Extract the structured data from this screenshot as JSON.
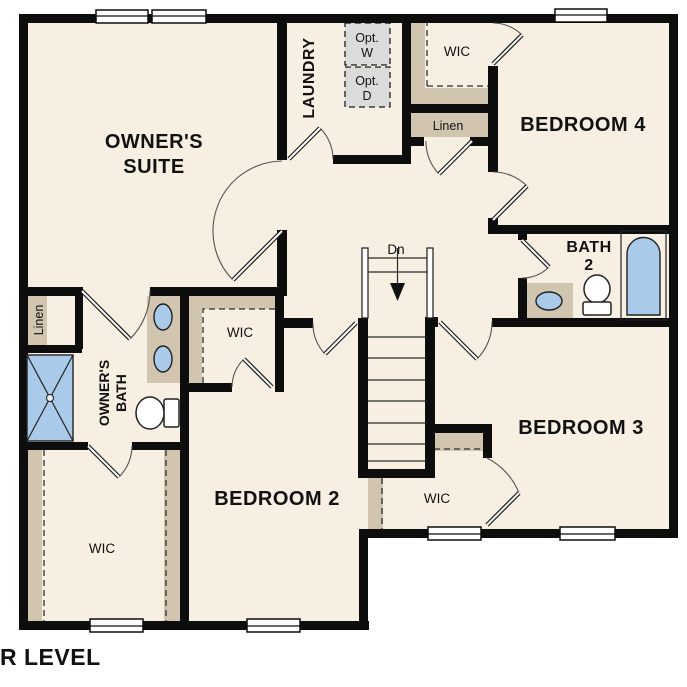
{
  "title": "UPPER LEVEL",
  "rooms": {
    "owners_suite_line1": "OWNER'S",
    "owners_suite_line2": "SUITE",
    "laundry": "LAUNDRY",
    "bedroom_4": "BEDROOM 4",
    "bedroom_3": "BEDROOM 3",
    "bedroom_2": "BEDROOM 2",
    "owners_bath_line1": "OWNER'S",
    "owners_bath_line2": "BATH",
    "bath_2_line1": "BATH",
    "bath_2_line2": "2"
  },
  "closets": {
    "owners_wic": "WIC",
    "bedroom_2_wic": "WIC",
    "bedroom_3_wic": "WIC",
    "bedroom_4_wic": "WIC",
    "owners_linen": "Linen",
    "hall_linen": "Linen"
  },
  "stairs": {
    "direction_label": "Dn"
  },
  "options": {
    "washer_line1": "Opt.",
    "washer_line2": "W",
    "dryer_line1": "Opt.",
    "dryer_line2": "D"
  },
  "colors": {
    "wall": "#0d0d0d",
    "floor": "#f6efe2",
    "closet_shelf": "#d1c5af",
    "fixture_blue": "#a9cbe9",
    "option_gray": "#dbdbdb",
    "background": "#ffffff"
  }
}
